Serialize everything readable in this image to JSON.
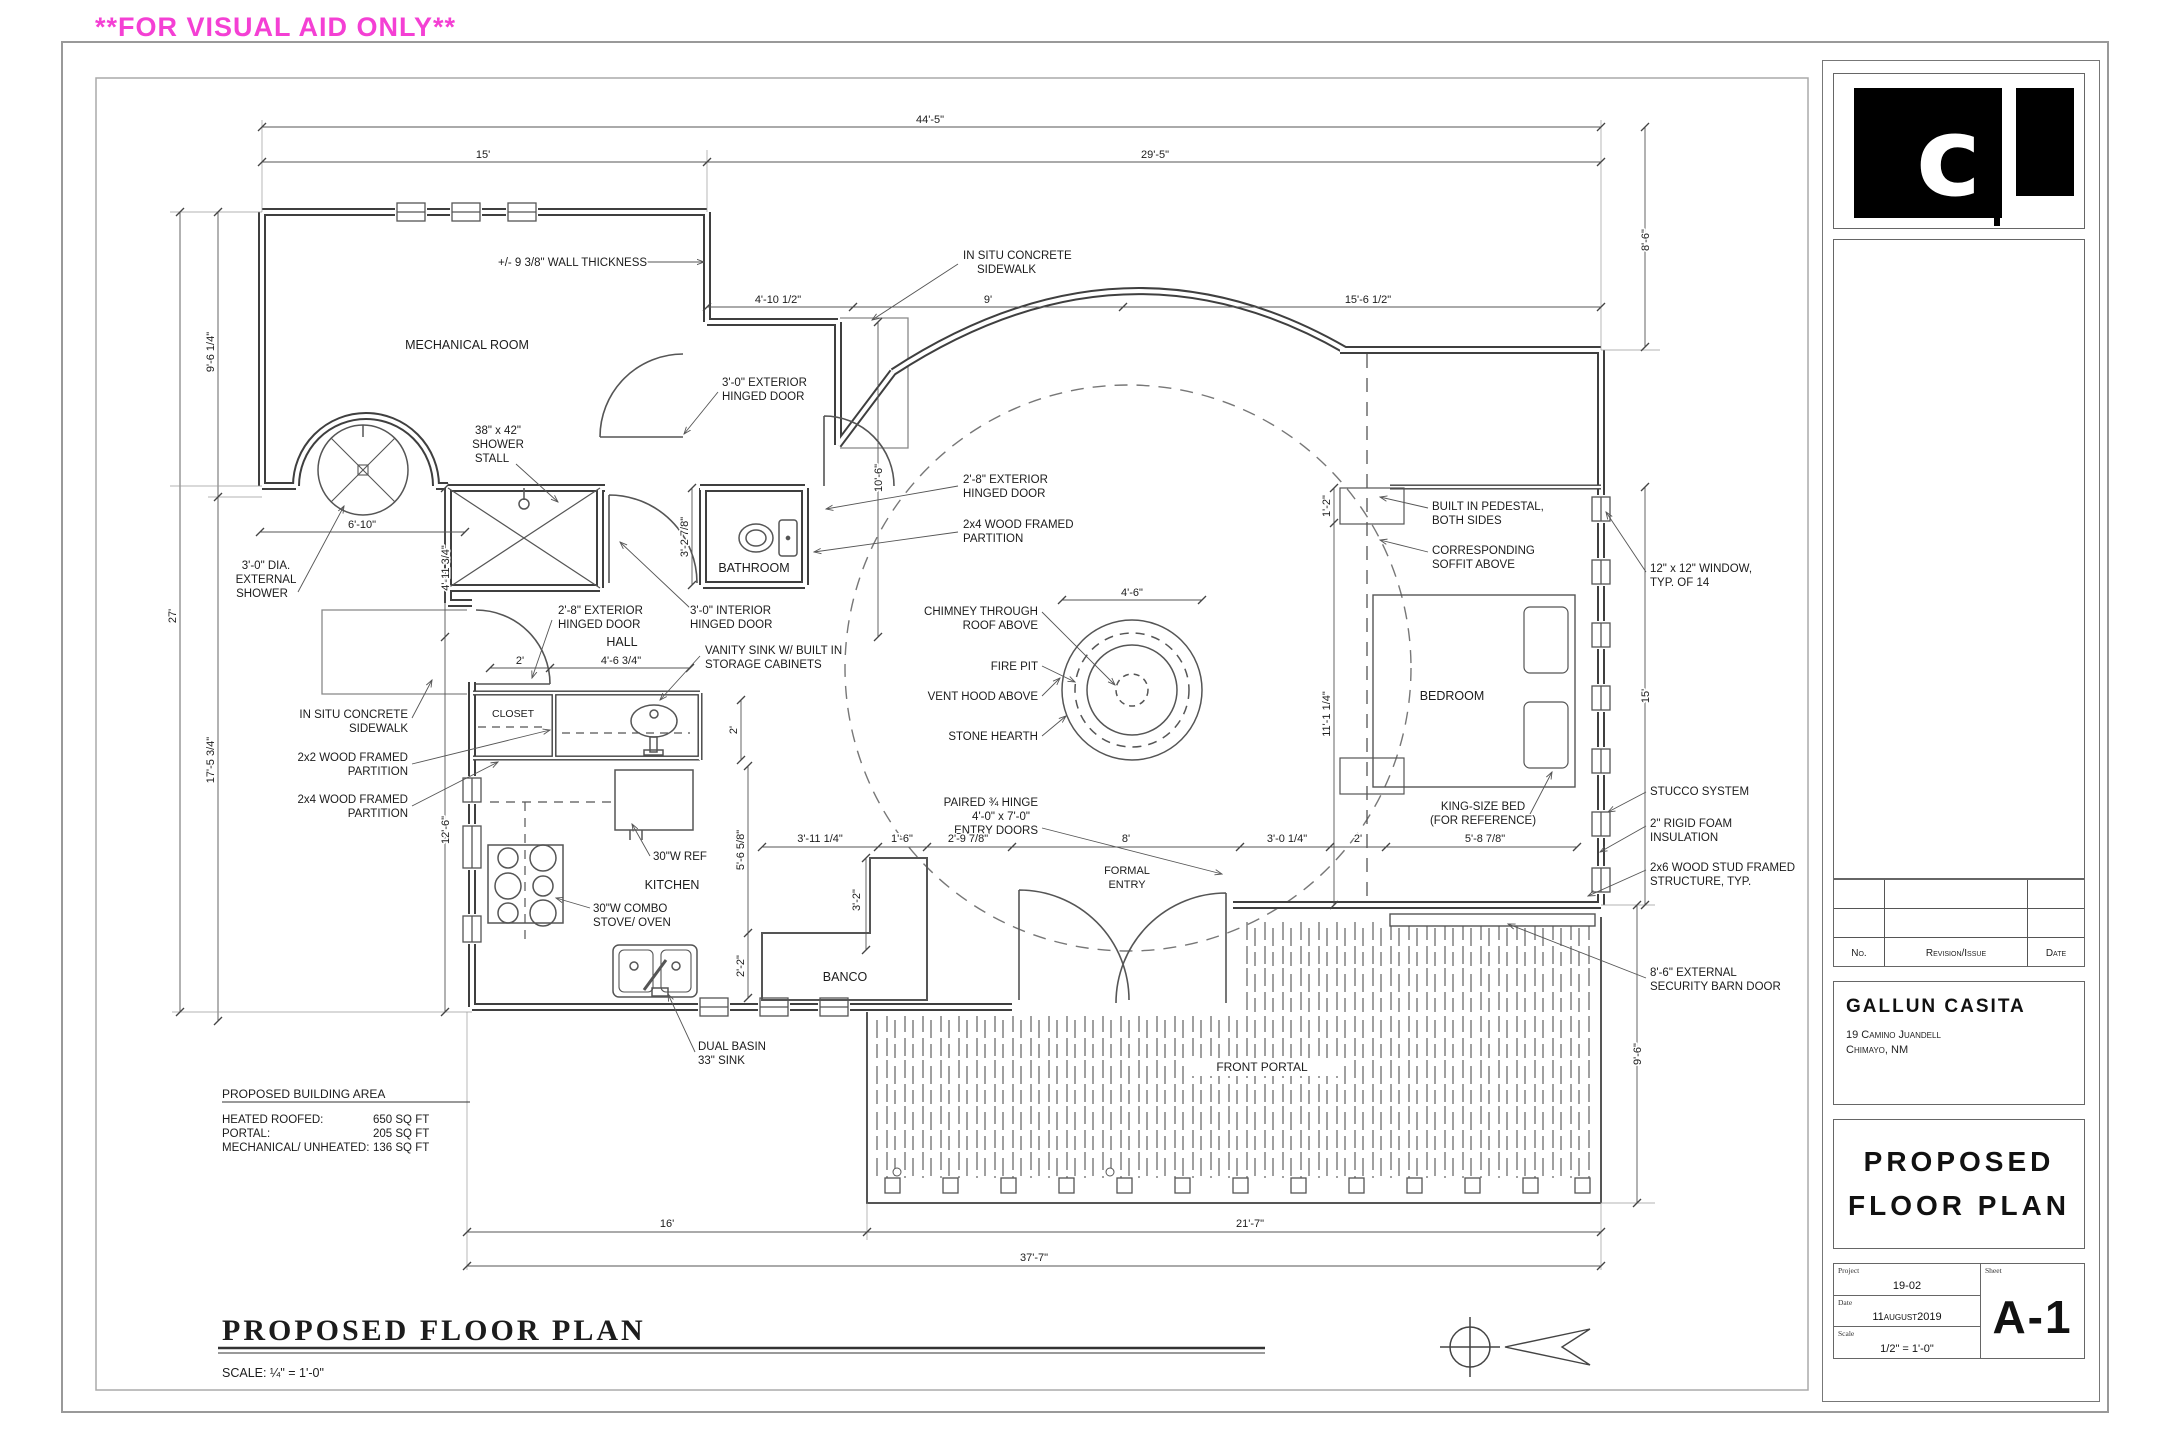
{
  "banner": {
    "text": "**FOR VISUAL AID ONLY**",
    "color": "#f440d4"
  },
  "titleblock": {
    "logo_glyph": "c",
    "revisions": {
      "no": "No.",
      "revision": "Revision/Issue",
      "date": "Date"
    },
    "client": {
      "name": "GALLUN CASITA",
      "address1": "19 Camino Juandell",
      "address2": "Chimayo, NM"
    },
    "sheet_title": {
      "line1": "PROPOSED",
      "line2": "FLOOR PLAN"
    },
    "info": {
      "project_label": "Project",
      "project": "19-02",
      "date_label": "Date",
      "date": "11august2019",
      "scale_label": "Scale",
      "scale": "1/2\" = 1'-0\"",
      "sheet_label": "Sheet",
      "sheet": "A-1"
    }
  },
  "plan": {
    "labels": [
      {
        "t": "MECHANICAL ROOM",
        "x": 467,
        "y": 349,
        "s": 12.5,
        "n": "room-label-mechanical"
      },
      {
        "t": "BATHROOM",
        "x": 754,
        "y": 572,
        "s": 12.5,
        "n": "room-label-bathroom"
      },
      {
        "t": "HALL",
        "x": 622,
        "y": 646,
        "s": 12.5,
        "n": "room-label-hall"
      },
      {
        "t": "CLOSET",
        "x": 513,
        "y": 717,
        "s": 10.5,
        "n": "room-label-closet"
      },
      {
        "t": "KITCHEN",
        "x": 672,
        "y": 889,
        "s": 12.5,
        "n": "room-label-kitchen"
      },
      {
        "t": "BANCO",
        "x": 845,
        "y": 981,
        "s": 12.5,
        "n": "room-label-banco"
      },
      {
        "t": "BEDROOM",
        "x": 1452,
        "y": 700,
        "s": 12.5,
        "n": "room-label-bedroom"
      },
      {
        "t": "FORMAL",
        "x": 1127,
        "y": 874,
        "s": 11,
        "n": "room-label-formal-entry"
      },
      {
        "t": "ENTRY",
        "x": 1127,
        "y": 888,
        "s": 11,
        "n": "room-label-formal-entry"
      },
      {
        "t": "FRONT PORTAL",
        "x": 1262,
        "y": 1071,
        "s": 12,
        "n": "room-label-front-portal"
      },
      {
        "t": "+/- 9 3/8\" WALL THICKNESS",
        "x": 498,
        "y": 266,
        "a": "s",
        "n": "callout-wall-thickness"
      },
      {
        "t": "IN SITU CONCRETE",
        "x": 963,
        "y": 259,
        "a": "s",
        "n": "callout-sidewalk-top"
      },
      {
        "t": "SIDEWALK",
        "x": 977,
        "y": 273,
        "a": "s",
        "n": "callout-sidewalk-top"
      },
      {
        "t": "3'-0\" EXTERIOR",
        "x": 722,
        "y": 386,
        "a": "s",
        "n": "callout-exterior-door"
      },
      {
        "t": "HINGED DOOR",
        "x": 722,
        "y": 400,
        "a": "s",
        "n": "callout-exterior-door"
      },
      {
        "t": "38\" x 42\"",
        "x": 498,
        "y": 434,
        "n": "callout-shower-stall"
      },
      {
        "t": "SHOWER",
        "x": 498,
        "y": 448,
        "n": "callout-shower-stall"
      },
      {
        "t": "STALL",
        "x": 492,
        "y": 462,
        "n": "callout-shower-stall"
      },
      {
        "t": "2'-8\" EXTERIOR",
        "x": 963,
        "y": 483,
        "a": "s",
        "n": "callout-bath-ext-door"
      },
      {
        "t": "HINGED DOOR",
        "x": 963,
        "y": 497,
        "a": "s",
        "n": "callout-bath-ext-door"
      },
      {
        "t": "2x4 WOOD FRAMED",
        "x": 963,
        "y": 528,
        "a": "s",
        "n": "callout-partition-2x4"
      },
      {
        "t": "PARTITION",
        "x": 963,
        "y": 542,
        "a": "s",
        "n": "callout-partition-2x4"
      },
      {
        "t": "3'-0\" DIA.",
        "x": 266,
        "y": 569,
        "n": "callout-external-shower"
      },
      {
        "t": "EXTERNAL",
        "x": 266,
        "y": 583,
        "n": "callout-external-shower"
      },
      {
        "t": "SHOWER",
        "x": 262,
        "y": 597,
        "n": "callout-external-shower"
      },
      {
        "t": "2'-8\" EXTERIOR",
        "x": 558,
        "y": 614,
        "a": "s",
        "n": "callout-hall-ext-door"
      },
      {
        "t": "HINGED DOOR",
        "x": 558,
        "y": 628,
        "a": "s",
        "n": "callout-hall-ext-door"
      },
      {
        "t": "3'-0\" INTERIOR",
        "x": 690,
        "y": 614,
        "a": "s",
        "n": "callout-interior-door"
      },
      {
        "t": "HINGED DOOR",
        "x": 690,
        "y": 628,
        "a": "s",
        "n": "callout-interior-door"
      },
      {
        "t": "VANITY SINK W/ BUILT IN",
        "x": 705,
        "y": 654,
        "a": "s",
        "n": "callout-vanity"
      },
      {
        "t": "STORAGE CABINETS",
        "x": 705,
        "y": 668,
        "a": "s",
        "n": "callout-vanity"
      },
      {
        "t": "IN SITU CONCRETE",
        "x": 408,
        "y": 718,
        "a": "e",
        "n": "callout-sidewalk-left"
      },
      {
        "t": "SIDEWALK",
        "x": 408,
        "y": 732,
        "a": "e",
        "n": "callout-sidewalk-left"
      },
      {
        "t": "2x2 WOOD FRAMED",
        "x": 408,
        "y": 761,
        "a": "e",
        "n": "callout-partition-2x2"
      },
      {
        "t": "PARTITION",
        "x": 408,
        "y": 775,
        "a": "e",
        "n": "callout-partition-2x2"
      },
      {
        "t": "2x4 WOOD FRAMED",
        "x": 408,
        "y": 803,
        "a": "e",
        "n": "callout-partition-2x4b"
      },
      {
        "t": "PARTITION",
        "x": 408,
        "y": 817,
        "a": "e",
        "n": "callout-partition-2x4b"
      },
      {
        "t": "CHIMNEY THROUGH",
        "x": 1038,
        "y": 615,
        "a": "e",
        "n": "callout-chimney"
      },
      {
        "t": "ROOF ABOVE",
        "x": 1038,
        "y": 629,
        "a": "e",
        "n": "callout-chimney"
      },
      {
        "t": "FIRE PIT",
        "x": 1038,
        "y": 670,
        "a": "e",
        "n": "callout-fire-pit"
      },
      {
        "t": "VENT HOOD ABOVE",
        "x": 1038,
        "y": 700,
        "a": "e",
        "n": "callout-vent-hood"
      },
      {
        "t": "STONE HEARTH",
        "x": 1038,
        "y": 740,
        "a": "e",
        "n": "callout-stone-hearth"
      },
      {
        "t": "PAIRED ¾ HINGE",
        "x": 1038,
        "y": 806,
        "a": "e",
        "n": "callout-entry-doors"
      },
      {
        "t": "4'-0\" x 7'-0\"",
        "x": 1030,
        "y": 820,
        "a": "e",
        "n": "callout-entry-doors"
      },
      {
        "t": "ENTRY DOORS",
        "x": 1038,
        "y": 834,
        "a": "e",
        "n": "callout-entry-doors"
      },
      {
        "t": "BUILT IN PEDESTAL,",
        "x": 1432,
        "y": 510,
        "a": "s",
        "n": "callout-pedestal"
      },
      {
        "t": "BOTH SIDES",
        "x": 1432,
        "y": 524,
        "a": "s",
        "n": "callout-pedestal"
      },
      {
        "t": "CORRESPONDING",
        "x": 1432,
        "y": 554,
        "a": "s",
        "n": "callout-soffit"
      },
      {
        "t": "SOFFIT ABOVE",
        "x": 1432,
        "y": 568,
        "a": "s",
        "n": "callout-soffit"
      },
      {
        "t": "12\" x 12\" WINDOW,",
        "x": 1650,
        "y": 572,
        "a": "s",
        "n": "callout-window-typ"
      },
      {
        "t": "TYP. OF 14",
        "x": 1650,
        "y": 586,
        "a": "s",
        "n": "callout-window-typ"
      },
      {
        "t": "KING-SIZE BED",
        "x": 1483,
        "y": 810,
        "n": "callout-king-bed"
      },
      {
        "t": "(FOR REFERENCE)",
        "x": 1483,
        "y": 824,
        "n": "callout-king-bed"
      },
      {
        "t": "STUCCO SYSTEM",
        "x": 1650,
        "y": 795,
        "a": "s",
        "n": "callout-stucco"
      },
      {
        "t": "2\" RIGID FOAM",
        "x": 1650,
        "y": 827,
        "a": "s",
        "n": "callout-insulation"
      },
      {
        "t": "INSULATION",
        "x": 1650,
        "y": 841,
        "a": "s",
        "n": "callout-insulation"
      },
      {
        "t": "2x6 WOOD STUD FRAMED",
        "x": 1650,
        "y": 871,
        "a": "s",
        "n": "callout-stud-structure"
      },
      {
        "t": "STRUCTURE, TYP.",
        "x": 1650,
        "y": 885,
        "a": "s",
        "n": "callout-stud-structure"
      },
      {
        "t": "8'-6\" EXTERNAL",
        "x": 1650,
        "y": 976,
        "a": "s",
        "n": "callout-barn-door"
      },
      {
        "t": "SECURITY BARN DOOR",
        "x": 1650,
        "y": 990,
        "a": "s",
        "n": "callout-barn-door"
      },
      {
        "t": "30\"W REF",
        "x": 653,
        "y": 860,
        "a": "s",
        "n": "callout-ref"
      },
      {
        "t": "30\"W COMBO",
        "x": 593,
        "y": 912,
        "a": "s",
        "n": "callout-stove"
      },
      {
        "t": "STOVE/ OVEN",
        "x": 593,
        "y": 926,
        "a": "s",
        "n": "callout-stove"
      },
      {
        "t": "DUAL BASIN",
        "x": 698,
        "y": 1050,
        "a": "s",
        "n": "callout-sink"
      },
      {
        "t": "33\" SINK",
        "x": 698,
        "y": 1064,
        "a": "s",
        "n": "callout-sink"
      },
      {
        "t": "44'-5\"",
        "x": 930,
        "y": 123,
        "s": 11,
        "n": "dim-label"
      },
      {
        "t": "15'",
        "x": 483,
        "y": 158,
        "s": 11,
        "n": "dim-label"
      },
      {
        "t": "29'-5\"",
        "x": 1155,
        "y": 158,
        "s": 11,
        "n": "dim-label"
      },
      {
        "t": "4'-10 1/2\"",
        "x": 778,
        "y": 303,
        "s": 11,
        "n": "dim-label"
      },
      {
        "t": "9'",
        "x": 988,
        "y": 303,
        "s": 11,
        "n": "dim-label"
      },
      {
        "t": "15'-6 1/2\"",
        "x": 1368,
        "y": 303,
        "s": 11,
        "n": "dim-label"
      },
      {
        "t": "8'-6\"",
        "x": 1649,
        "y": 240,
        "r": 1,
        "s": 11,
        "n": "dim-label"
      },
      {
        "t": "15'",
        "x": 1649,
        "y": 696,
        "r": 1,
        "s": 11,
        "n": "dim-label"
      },
      {
        "t": "9'-6\"",
        "x": 1641,
        "y": 1054,
        "r": 1,
        "s": 11,
        "n": "dim-label"
      },
      {
        "t": "9'-6 1/4\"",
        "x": 214,
        "y": 352,
        "r": 1,
        "s": 11,
        "n": "dim-label"
      },
      {
        "t": "27'",
        "x": 176,
        "y": 616,
        "r": 1,
        "s": 11,
        "n": "dim-label"
      },
      {
        "t": "17'-5 3/4\"",
        "x": 214,
        "y": 760,
        "r": 1,
        "s": 11,
        "n": "dim-label"
      },
      {
        "t": "6'-10\"",
        "x": 362,
        "y": 528,
        "s": 11,
        "n": "dim-label"
      },
      {
        "t": "4'-11 3/4\"",
        "x": 449,
        "y": 568,
        "r": 1,
        "s": 11,
        "n": "dim-label"
      },
      {
        "t": "3'-2 7/8\"",
        "x": 688,
        "y": 537,
        "r": 1,
        "s": 11,
        "n": "dim-label"
      },
      {
        "t": "10'-6\"",
        "x": 882,
        "y": 478,
        "r": 1,
        "s": 11,
        "n": "dim-label"
      },
      {
        "t": "2'",
        "x": 520,
        "y": 664,
        "s": 11,
        "n": "dim-label"
      },
      {
        "t": "4'-6 3/4\"",
        "x": 621,
        "y": 664,
        "s": 11,
        "n": "dim-label"
      },
      {
        "t": "2'",
        "x": 737,
        "y": 730,
        "r": 1,
        "s": 11,
        "n": "dim-label"
      },
      {
        "t": "12'-6\"",
        "x": 449,
        "y": 830,
        "r": 1,
        "s": 11,
        "n": "dim-label"
      },
      {
        "t": "5'-6 5/8\"",
        "x": 744,
        "y": 850,
        "r": 1,
        "s": 11,
        "n": "dim-label"
      },
      {
        "t": "2'-2\"",
        "x": 744,
        "y": 966,
        "r": 1,
        "s": 11,
        "n": "dim-label"
      },
      {
        "t": "4'-6\"",
        "x": 1132,
        "y": 596,
        "s": 11,
        "n": "dim-label"
      },
      {
        "t": "3'-11 1/4\"",
        "x": 820,
        "y": 842,
        "s": 11,
        "n": "dim-label"
      },
      {
        "t": "1'-6\"",
        "x": 902,
        "y": 842,
        "s": 11,
        "n": "dim-label"
      },
      {
        "t": "2'-9 7/8\"",
        "x": 968,
        "y": 842,
        "s": 11,
        "n": "dim-label"
      },
      {
        "t": "8'",
        "x": 1126,
        "y": 842,
        "s": 11,
        "n": "dim-label"
      },
      {
        "t": "3'-0 1/4\"",
        "x": 1287,
        "y": 842,
        "s": 11,
        "n": "dim-label"
      },
      {
        "t": "2'",
        "x": 1358,
        "y": 842,
        "s": 11,
        "n": "dim-label"
      },
      {
        "t": "5'-8 7/8\"",
        "x": 1485,
        "y": 842,
        "s": 11,
        "n": "dim-label"
      },
      {
        "t": "3'-2\"",
        "x": 860,
        "y": 900,
        "r": 1,
        "s": 11,
        "n": "dim-label"
      },
      {
        "t": "1'-2\"",
        "x": 1330,
        "y": 506,
        "r": 1,
        "s": 11,
        "n": "dim-label"
      },
      {
        "t": "11'-1 1/4\"",
        "x": 1330,
        "y": 714,
        "r": 1,
        "s": 11,
        "n": "dim-label"
      },
      {
        "t": "16'",
        "x": 667,
        "y": 1227,
        "s": 11,
        "n": "dim-label"
      },
      {
        "t": "21'-7\"",
        "x": 1250,
        "y": 1227,
        "s": 11,
        "n": "dim-label"
      },
      {
        "t": "37'-7\"",
        "x": 1034,
        "y": 1261,
        "s": 11,
        "n": "dim-label"
      },
      {
        "t": "PROPOSED BUILDING AREA",
        "x": 222,
        "y": 1098,
        "a": "s",
        "s": 12,
        "n": "building-area-heading"
      },
      {
        "t": "HEATED ROOFED:",
        "x": 222,
        "y": 1123,
        "a": "s",
        "s": 11.5,
        "n": "building-area-row"
      },
      {
        "t": "650 SQ FT",
        "x": 373,
        "y": 1123,
        "a": "s",
        "s": 11.5,
        "n": "building-area-value"
      },
      {
        "t": "PORTAL:",
        "x": 222,
        "y": 1137,
        "a": "s",
        "s": 11.5,
        "n": "building-area-row"
      },
      {
        "t": "205 SQ FT",
        "x": 373,
        "y": 1137,
        "a": "s",
        "s": 11.5,
        "n": "building-area-value"
      },
      {
        "t": "MECHANICAL/ UNHEATED:",
        "x": 222,
        "y": 1151,
        "a": "s",
        "s": 11.5,
        "n": "building-area-row"
      },
      {
        "t": "136 SQ FT",
        "x": 373,
        "y": 1151,
        "a": "s",
        "s": 11.5,
        "n": "building-area-value"
      },
      {
        "t": "PROPOSED FLOOR PLAN",
        "x": 222,
        "y": 1340,
        "a": "s",
        "s": 30,
        "serif": 1,
        "b": 1,
        "sp": 3,
        "n": "drawing-title"
      },
      {
        "t": "SCALE: ¼\" = 1'-0\"",
        "x": 222,
        "y": 1377,
        "a": "s",
        "s": 12.5,
        "n": "drawing-scale"
      }
    ]
  }
}
